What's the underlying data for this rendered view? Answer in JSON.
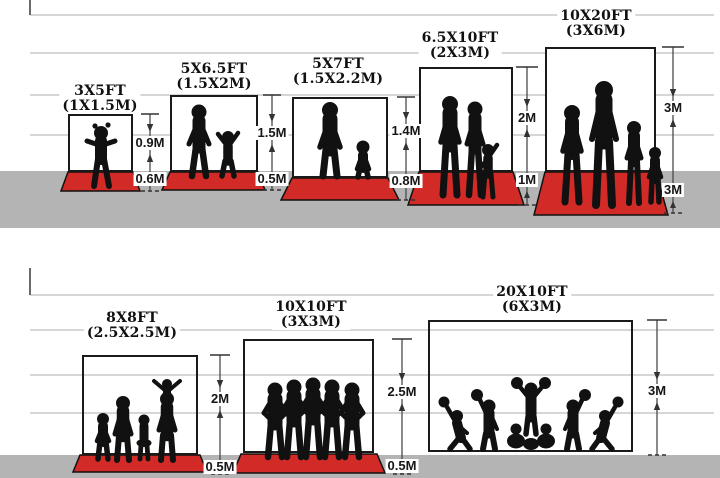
{
  "diagram": {
    "rows": [
      {
        "panels": [
          {
            "size_ft": "3X5FT",
            "size_m": "(1X1.5M)",
            "height_label": "0.9M",
            "depth_label": "0.6M"
          },
          {
            "size_ft": "5X6.5FT",
            "size_m": "(1.5X2M)",
            "height_label": "1.5M",
            "depth_label": "0.5M"
          },
          {
            "size_ft": "5X7FT",
            "size_m": "(1.5X2.2M)",
            "height_label": "1.4M",
            "depth_label": "0.8M"
          },
          {
            "size_ft": "6.5X10FT",
            "size_m": "(2X3M)",
            "height_label": "2M",
            "depth_label": "1M"
          },
          {
            "size_ft": "10X20FT",
            "size_m": "(3X6M)",
            "height_label": "3M",
            "depth_label": "3M"
          }
        ]
      },
      {
        "panels": [
          {
            "size_ft": "8X8FT",
            "size_m": "(2.5X2.5M)",
            "height_label": "2M",
            "depth_label": "0.5M"
          },
          {
            "size_ft": "10X10FT",
            "size_m": "(3X3M)",
            "height_label": "2.5M",
            "depth_label": "0.5M"
          },
          {
            "size_ft": "20X10FT",
            "size_m": "(6X3M)",
            "height_label": "3M",
            "depth_label": null
          }
        ]
      }
    ]
  },
  "colors": {
    "carpet_red": "#d22b27",
    "ground_gray": "#b4b4b4",
    "gridline": "#c9c9c9",
    "ink": "#111111"
  }
}
